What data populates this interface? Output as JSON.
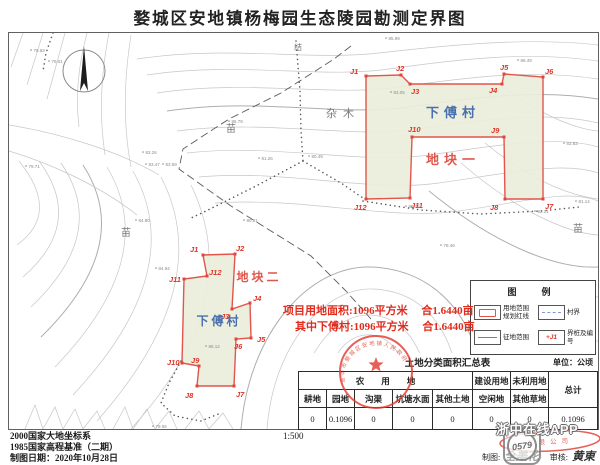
{
  "title": "婺城区安地镇杨梅园生态陵园勘测定界图",
  "map": {
    "plots": [
      {
        "name": "地块一",
        "vertices": [
          {
            "label": "J1",
            "x": 357,
            "y": 43,
            "dx": -16,
            "dy": -2
          },
          {
            "label": "J2",
            "x": 392,
            "y": 42,
            "dx": -5,
            "dy": -4
          },
          {
            "label": "J3",
            "x": 401,
            "y": 51,
            "dx": 1,
            "dy": 10
          },
          {
            "label": "J4",
            "x": 493,
            "y": 51,
            "dx": -13,
            "dy": 9
          },
          {
            "label": "J5",
            "x": 495,
            "y": 41,
            "dx": -4,
            "dy": -4
          },
          {
            "label": "J6",
            "x": 534,
            "y": 44,
            "dx": 2,
            "dy": -3
          },
          {
            "label": "J7",
            "x": 534,
            "y": 166,
            "dx": 2,
            "dy": 10
          },
          {
            "label": "J8",
            "x": 496,
            "y": 166,
            "dx": -15,
            "dy": 11
          },
          {
            "label": "J9",
            "x": 495,
            "y": 104,
            "dx": -13,
            "dy": -4
          },
          {
            "label": "J10",
            "x": 403,
            "y": 104,
            "dx": -4,
            "dy": -5
          },
          {
            "label": "J11",
            "x": 401,
            "y": 165,
            "dx": 1,
            "dy": 10
          },
          {
            "label": "J12",
            "x": 357,
            "y": 166,
            "dx": -12,
            "dy": 11
          }
        ]
      },
      {
        "name": "地块二",
        "vertices": [
          {
            "label": "J1",
            "x": 194,
            "y": 222,
            "dx": -13,
            "dy": -3
          },
          {
            "label": "J2",
            "x": 226,
            "y": 221,
            "dx": 1,
            "dy": -3
          },
          {
            "label": "J3",
            "x": 223,
            "y": 276,
            "dx": -11,
            "dy": 10
          },
          {
            "label": "J4",
            "x": 241,
            "y": 270,
            "dx": 3,
            "dy": -2
          },
          {
            "label": "J5",
            "x": 242,
            "y": 305,
            "dx": 6,
            "dy": 4
          },
          {
            "label": "J6",
            "x": 227,
            "y": 306,
            "dx": -2,
            "dy": 10
          },
          {
            "label": "J7",
            "x": 225,
            "y": 353,
            "dx": 2,
            "dy": 11
          },
          {
            "label": "J8",
            "x": 188,
            "y": 353,
            "dx": -12,
            "dy": 12
          },
          {
            "label": "J9",
            "x": 190,
            "y": 333,
            "dx": -8,
            "dy": -3
          },
          {
            "label": "J10",
            "x": 173,
            "y": 330,
            "dx": -15,
            "dy": 2
          },
          {
            "label": "J11",
            "x": 175,
            "y": 246,
            "dx": -15,
            "dy": 3
          },
          {
            "label": "J12",
            "x": 198,
            "y": 243,
            "dx": 2,
            "dy": -1
          }
        ]
      }
    ],
    "area_labels": [
      {
        "text": "下傅村",
        "x": 444,
        "y": 84,
        "cls": "blue",
        "size": 13,
        "ls": 5
      },
      {
        "text": "地块一",
        "x": 444,
        "y": 131,
        "cls": "red",
        "size": 13,
        "ls": 5
      },
      {
        "text": "地块二",
        "x": 250,
        "y": 248,
        "cls": "red",
        "size": 12,
        "ls": 3
      },
      {
        "text": "下傅村",
        "x": 210,
        "y": 292,
        "cls": "blue",
        "size": 12,
        "ls": 3
      },
      {
        "text": "杂木",
        "x": 334,
        "y": 84,
        "cls": "gray",
        "size": 11,
        "ls": 6
      },
      {
        "text": "苗",
        "x": 222,
        "y": 99,
        "cls": "gray",
        "size": 10,
        "ls": 0
      },
      {
        "text": "苗",
        "x": 117,
        "y": 203,
        "cls": "gray",
        "size": 10,
        "ls": 0
      },
      {
        "text": "苗",
        "x": 569,
        "y": 199,
        "cls": "gray",
        "size": 10,
        "ls": 0
      },
      {
        "text": "结",
        "x": 289,
        "y": 17,
        "cls": "gray",
        "size": 8,
        "ls": 0
      }
    ],
    "spot_heights": [
      {
        "x": 22,
        "y": 17,
        "v": "78.63"
      },
      {
        "x": 40,
        "y": 28,
        "v": "79.01"
      },
      {
        "x": 17,
        "y": 133,
        "v": "79.71"
      },
      {
        "x": 134,
        "y": 119,
        "v": "83.26"
      },
      {
        "x": 137,
        "y": 131,
        "v": "83.47"
      },
      {
        "x": 154,
        "y": 131,
        "v": "83.59"
      },
      {
        "x": 127,
        "y": 187,
        "v": "84.80"
      },
      {
        "x": 147,
        "y": 235,
        "v": "84.94"
      },
      {
        "x": 377,
        "y": 5,
        "v": "85.99"
      },
      {
        "x": 509,
        "y": 27,
        "v": "86.49"
      },
      {
        "x": 382,
        "y": 59,
        "v": "83.05"
      },
      {
        "x": 555,
        "y": 110,
        "v": "83.83"
      },
      {
        "x": 567,
        "y": 168,
        "v": "81.14"
      },
      {
        "x": 526,
        "y": 178,
        "v": "82.21"
      },
      {
        "x": 250,
        "y": 125,
        "v": "81.26"
      },
      {
        "x": 300,
        "y": 123,
        "v": "80.49"
      },
      {
        "x": 235,
        "y": 187,
        "v": "80.91"
      },
      {
        "x": 197,
        "y": 313,
        "v": "85.12"
      },
      {
        "x": 397,
        "y": 173,
        "v": "85.76"
      },
      {
        "x": 144,
        "y": 393,
        "v": "79.06"
      },
      {
        "x": 432,
        "y": 212,
        "v": "78.46"
      },
      {
        "x": 220,
        "y": 88,
        "v": "86.79"
      }
    ]
  },
  "red_notes": {
    "line1": "项目用地面积:1096平方米　 合1.6440亩",
    "line2": "其中下傅村:1096平方米　 合1.6440亩"
  },
  "legend": {
    "title": "图　例",
    "item1_label1": "用地范围",
    "item1_label2": "规划红线",
    "item2_label": "村界",
    "item3_label": "征地范围",
    "item4_label": "界桩及编号",
    "item4_marker": "+J1"
  },
  "table": {
    "title": "土地分类面积汇总表",
    "unit": "单位：公顷",
    "groups": [
      {
        "label": "农　　用　　地",
        "span": 5
      },
      {
        "label": "建设用地",
        "span": 1
      },
      {
        "label": "未利用地",
        "span": 1
      }
    ],
    "total_label": "总计",
    "columns": [
      "耕地",
      "园地",
      "沟渠",
      "坑塘水面",
      "其他土地",
      "空闲地",
      "其他草地"
    ],
    "values": [
      "0",
      "0.1096",
      "0",
      "0",
      "0",
      "0",
      "0",
      "0.1096"
    ]
  },
  "footer": {
    "datum": "2000国家大地坐标系",
    "height_datum": "1985国家高程基准（二期）",
    "date": "制图日期：2020年10月28日",
    "scale": "1:500",
    "drafter_label": "制图:",
    "drafter": "全美花",
    "reviewer_label": "审核:",
    "reviewer": "黄東"
  },
  "stamps": {
    "round_text": "金华市婺城区安地镇人民政府",
    "oval_text": "有限公司"
  },
  "watermark": {
    "badge": "0579",
    "text": "浙中在线APP"
  },
  "colors": {
    "plot_stroke": "#e0564c",
    "plot_fill": "#eaeeda",
    "village_blue": "#4a6fae",
    "note_red": "#e02b1d",
    "stamp_red": "#e0392e"
  }
}
